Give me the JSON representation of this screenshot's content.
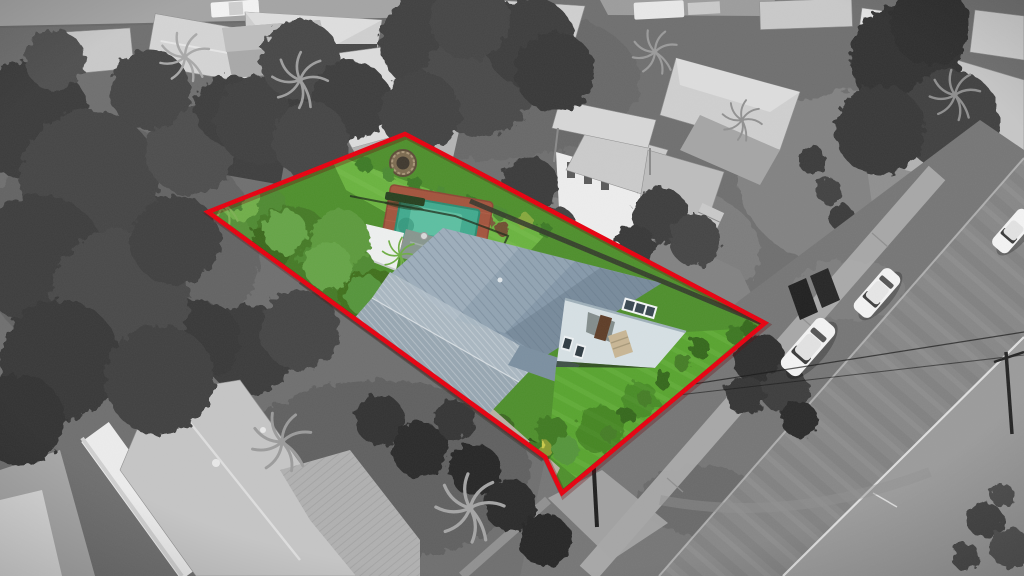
{
  "meta": {
    "type": "aerial-drone-photograph",
    "style": "selective-color real estate photo: property in color, surroundings grayscale, red lot outline",
    "canvas": {
      "width": 1024,
      "height": 576
    }
  },
  "colors": {
    "boundary_red": "#e8000f",
    "boundary_shadow": "#6d0005",
    "pool_water": "#41aa8e",
    "pool_water_light": "#63c4a6",
    "pool_paving": "#a3543d",
    "lawn_green": "#4e8f2c",
    "lawn_bright": "#6ab33f",
    "front_lawn": "#58a42f",
    "tree_green": "#447a28",
    "tree_green_light": "#6fae4a",
    "roof_main": "#8598a9",
    "roof_main_light": "#b0bfca",
    "roof_skillion": "#a9b7c1",
    "roof_carport": "#8d9aa4",
    "house_wall": "#d6e0e4",
    "door_brown": "#5e3d27",
    "shade_sail_white": "#eef0ef",
    "rear_roof_green_gray": "#87968e",
    "road_gray": "#878787",
    "road_shoulder": "#9b9b9b",
    "verge_gray": "#767676",
    "footpath_gray": "#b0b0b0",
    "kerb_line": "#c8c8c8",
    "road_edge_line": "#e8e8e8",
    "neighbor_roof_gray": "#cfcfcf",
    "tree_gray_dark": "#3a3a3a",
    "car_white": "#f3f3f3",
    "ground_gray": "#6f6f6f"
  },
  "scene": {
    "boundary": {
      "points_svg": "208,212 405,134 765,323 562,493 545,457",
      "stroke_width": "4.5"
    },
    "property_features": [
      "back-lawn",
      "fire-pit-ring",
      "garden-beds",
      "swimming-pool",
      "brick-pool-paving",
      "pool-safety-fence",
      "garden-bench",
      "white-shade-sail",
      "palm-trees",
      "large-green-trees",
      "blue-metal-main-roof",
      "skillion-and-carport-roofs",
      "pale-front-wall-with-door-windows-steps",
      "front-lawn",
      "timber-front-fence",
      "concrete-driveway"
    ],
    "surroundings_features": [
      "grayscale-neighborhood",
      "top-road-with-two-white-vehicles",
      "neighbor-metal-roofs",
      "light-canopy-roof",
      "two-storey-neighbor-house",
      "dense-dark-trees-and-palms",
      "diagonal-front-street",
      "concrete-footpath",
      "grass-verge",
      "three-white-parked-cars",
      "power-poles-and-wires",
      "road-edge-line",
      "large-hip-roof-house-bottom-left"
    ],
    "vehicles": {
      "parked_cars_front_street": 3,
      "vehicles_top_road": 2
    }
  }
}
